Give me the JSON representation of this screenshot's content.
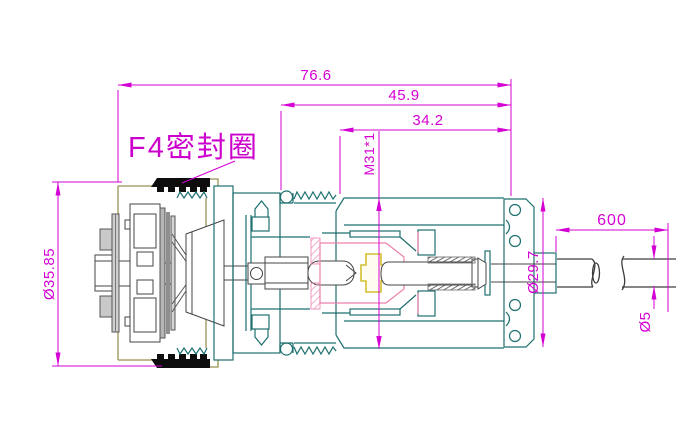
{
  "drawing": {
    "type": "engineering-cross-section-drawing",
    "part_label": "F4密封圈",
    "dims": {
      "overall_length": "76.6",
      "body_length": "45.9",
      "thread_length": "34.2",
      "thread_spec": "M31*1",
      "flange_od": "Ø35.85",
      "nut_od": "Ø29.7",
      "cable_length": "600",
      "cable_od": "Ø5"
    },
    "colors": {
      "dimension_magenta": "#d400d4",
      "label_magenta": "#cc00cc",
      "body_teal": "#1e6f6f",
      "shell_khaki": "#9a9153",
      "seal_black": "#0d0d0d",
      "insulator_yellow": "#d2c032",
      "contact_pink": "#ec7fae",
      "internal_gray": "#b5b5b5",
      "background": "#ffffff"
    }
  }
}
